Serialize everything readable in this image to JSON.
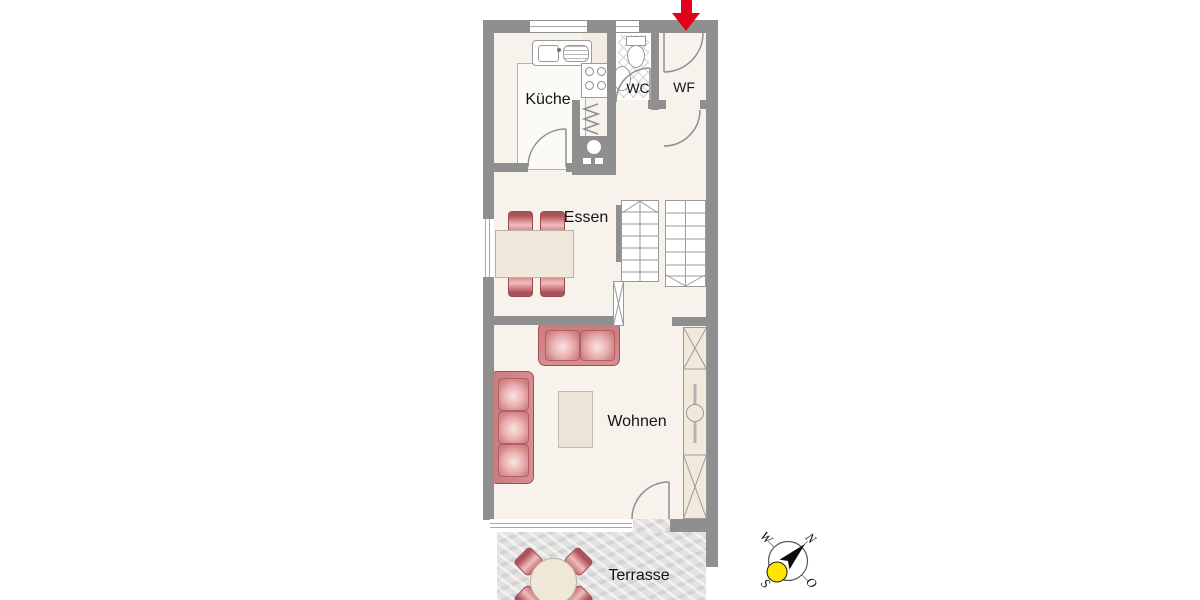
{
  "plan": {
    "rooms": {
      "kueche": {
        "label": "Küche"
      },
      "wc": {
        "label": "WC"
      },
      "wf": {
        "label": "WF"
      },
      "essen": {
        "label": "Essen"
      },
      "wohnen": {
        "label": "Wohnen"
      },
      "terrasse": {
        "label": "Terrasse"
      }
    },
    "compass": {
      "n": "N",
      "o": "O",
      "s": "S",
      "w": "W"
    },
    "icons": {
      "entrance": "entrance-arrow-icon",
      "compass": "compass-icon",
      "stairs": "stairs-icon",
      "radiator": "radiator-icon",
      "boiler": "boiler-icon"
    }
  },
  "colors": {
    "wall": "#8f8f8f",
    "floor": "#f8f2ec",
    "terrace": "#e3e2e0",
    "chairRed": "#c87479",
    "chairRedDark": "#9b4a50",
    "sofaRed": "#d88e91",
    "tableBeige": "#eee7da",
    "tableBorder": "#b9b3a6",
    "counterWhite": "#fcfaf6",
    "arrowRed": "#e2001a",
    "sunYellow": "#ffe500",
    "lineGray": "#9a9a9a",
    "labelColor": "#141414"
  }
}
